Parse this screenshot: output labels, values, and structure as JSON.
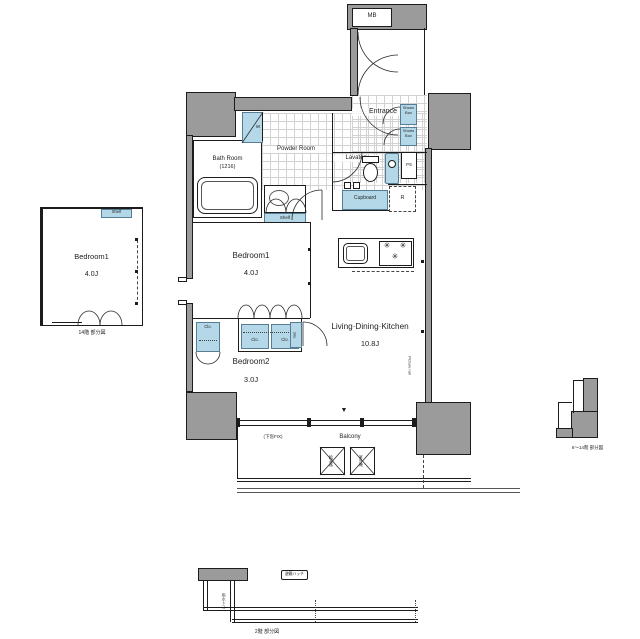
{
  "colors": {
    "wall_gray": "#9b9b9b",
    "fixture_blue": "#b4d8e8",
    "line": "#1c1c1c"
  },
  "main_plan": {
    "mb": "MB",
    "entrance": "Entrance",
    "shoes_box": "Shoes Box",
    "ps": "PS",
    "lavatory": "Lavatory",
    "bath_room": "Bath Room",
    "bath_size": "(1216)",
    "powder_room": "Powder Room",
    "washer": "W",
    "shelf": "Shelf",
    "cupboard": "Cupboard",
    "fridge": "R",
    "bedroom1": "Bedroom1",
    "bedroom1_size": "4.0J",
    "bedroom2": "Bedroom2",
    "bedroom2_size": "3.0J",
    "ldk": "Living·Dining·Kitchen",
    "ldk_size": "10.8J",
    "closet": "Clo.",
    "storage": "Sto.",
    "picture_rail": "Picture rail",
    "balcony": "Balcony",
    "fixed_window": "(下窓FIX)",
    "water_heater": "給湯器",
    "ac_outdoor": "室外機",
    "entry_marker": "▼",
    "burner": "✳"
  },
  "floor14_detail": {
    "room": "Bedroom1",
    "size": "4.0J",
    "shelf": "Shelf",
    "caption": "14階 部分図"
  },
  "floor6_14_detail": {
    "caption": "6〜14階 部分図"
  },
  "floor2_detail": {
    "hatch": "避難ハッチ",
    "drain": "雨水トヨ",
    "caption": "2階 部分図"
  }
}
